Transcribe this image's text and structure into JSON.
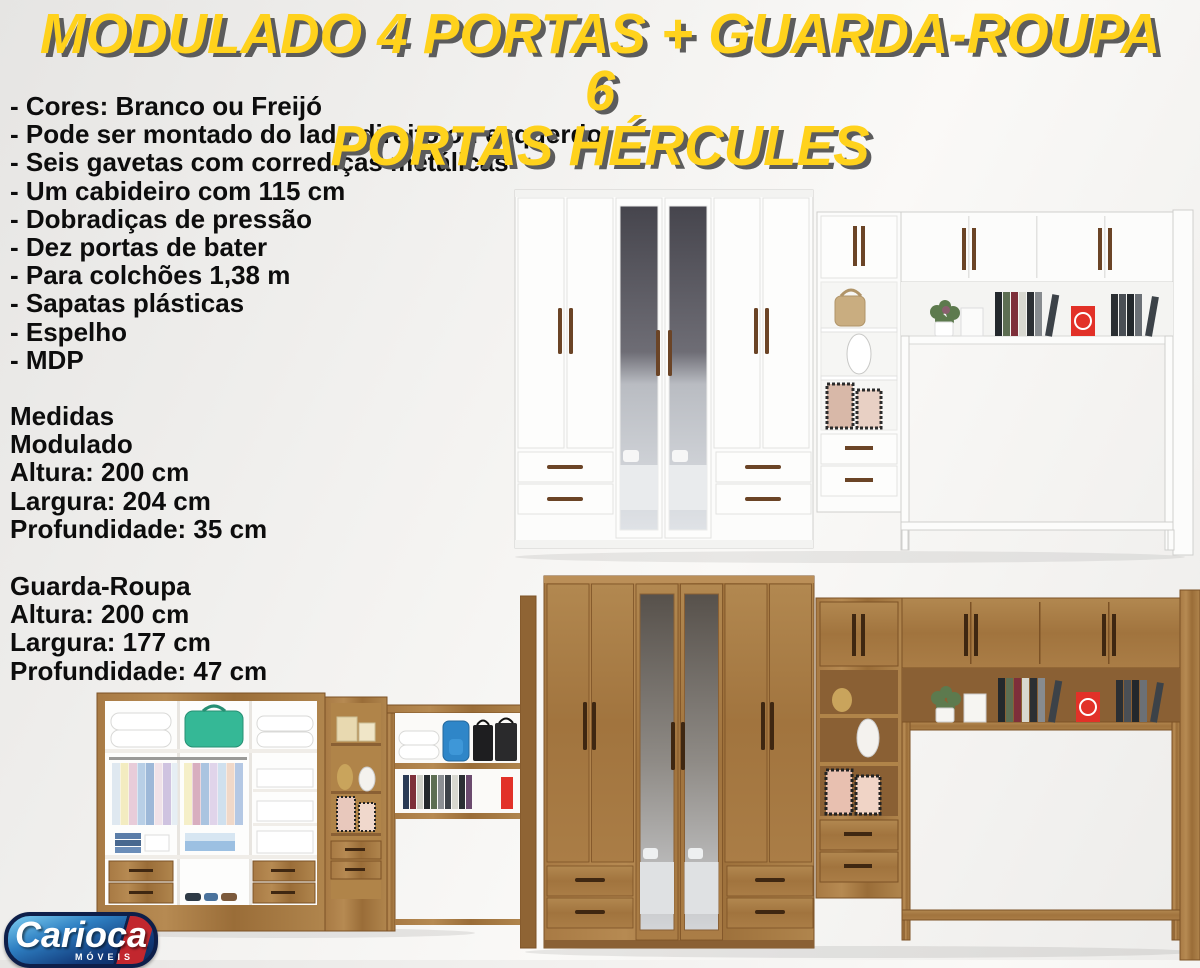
{
  "title": {
    "line1": "MODULADO 4 PORTAS + GUARDA-ROUPA 6",
    "line2": "PORTAS HÉRCULES"
  },
  "features": [
    "- Cores: Branco ou Freijó",
    "- Pode ser montado do lado direito ou esquerdo",
    "- Seis gavetas com corrediças metálicas",
    "- Um cabideiro com 115 cm",
    "- Dobradiças de pressão",
    "- Dez portas de bater",
    "- Para colchões 1,38 m",
    "- Sapatas plásticas",
    "- Espelho",
    "- MDP"
  ],
  "medidas": {
    "heading": "Medidas",
    "modulado": {
      "name": "Modulado",
      "lines": [
        "Altura: 200 cm",
        "Largura: 204 cm",
        "Profundidade: 35 cm"
      ]
    },
    "guarda_roupa": {
      "name": "Guarda-Roupa",
      "lines": [
        "Altura: 200 cm",
        "Largura: 177 cm",
        "Profundidade: 47 cm"
      ]
    }
  },
  "logo": {
    "brand": "Carioca",
    "tagline": "MÓVEIS"
  },
  "colors": {
    "title_yellow": "#FFD21C",
    "title_shadow": "#5C5C5C",
    "text": "#0D0D0D",
    "wood": "#A97C45",
    "wood_dark": "#7C5226",
    "white_furniture": "#FCFCFB",
    "handle_brown": "#6B4426",
    "logo_navy": "#0E1F4A",
    "logo_red": "#C2272E",
    "accent_red_decor": "#E23128",
    "teal_bag": "#35B896",
    "background": "#EDECEA"
  }
}
